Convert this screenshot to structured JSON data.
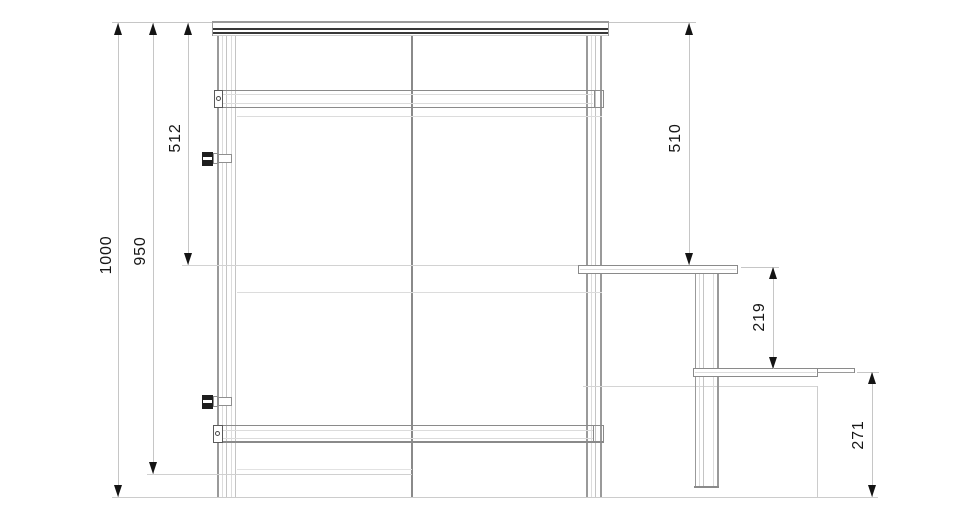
{
  "drawing": {
    "kind": "technical elevation drawing",
    "units": "mm",
    "palette": {
      "background": "#ffffff",
      "main_line": "#8a8a8a",
      "light_line": "#dcdcdc",
      "dimension_line": "#c6c6c6",
      "dark_band": "#383838",
      "text": "#161616"
    },
    "dimensions": [
      {
        "id": "overall-height",
        "value": "1000",
        "orientation": "vertical",
        "side": "left"
      },
      {
        "id": "frame-height",
        "value": "950",
        "orientation": "vertical",
        "side": "left"
      },
      {
        "id": "upper-section-left",
        "value": "512",
        "orientation": "vertical",
        "side": "left"
      },
      {
        "id": "upper-section-right",
        "value": "510",
        "orientation": "vertical",
        "side": "right"
      },
      {
        "id": "counter-step-height",
        "value": "219",
        "orientation": "vertical",
        "side": "right"
      },
      {
        "id": "counter-base-height",
        "value": "271",
        "orientation": "vertical",
        "side": "right"
      }
    ]
  }
}
